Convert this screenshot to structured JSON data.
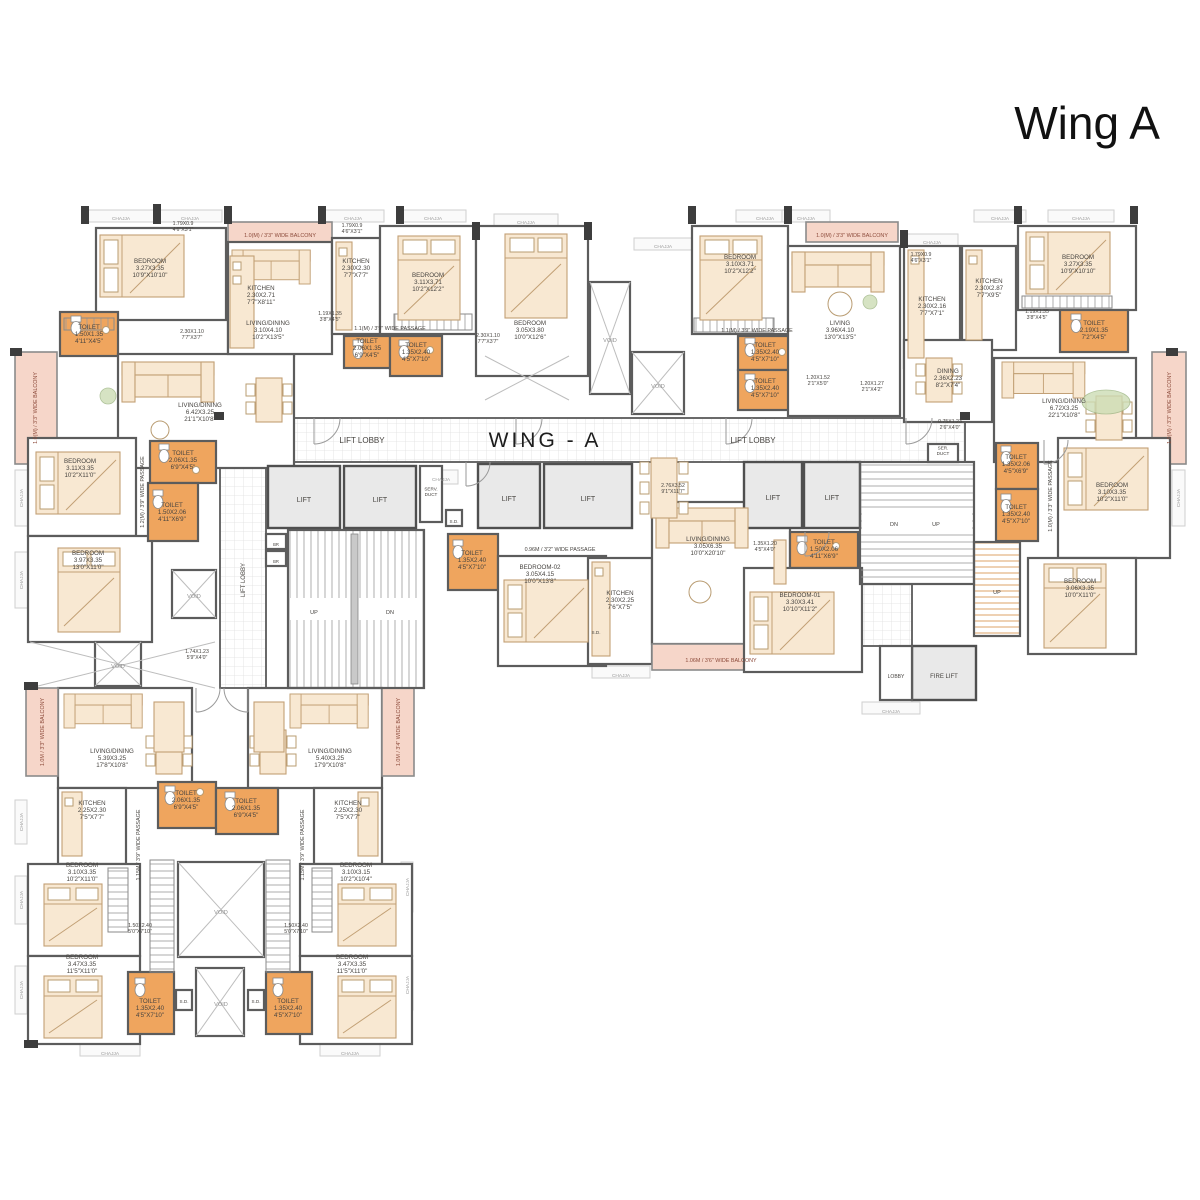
{
  "title": "Wing A",
  "colors": {
    "wall": "#5c5c5c",
    "label": "#474440",
    "heading": "#1d1d1d",
    "balcony": "#8c4a3a",
    "void": "#8f8f8f",
    "muted": "#9a9a9a",
    "toilet_fill": "#efa55e",
    "balcony_fill": "#f6d6c9",
    "furniture_fill": "#f8e8d2",
    "lift_fill": "#e9e9e9"
  },
  "plan": {
    "labels": [
      {
        "id": "wing-a-label",
        "t": "WING - A",
        "x": 545,
        "y": 445,
        "s": 21,
        "sp": 3,
        "c": "heading"
      },
      {
        "t": "LIFT LOBBY",
        "x": 362,
        "y": 441,
        "s": 8
      },
      {
        "t": "LIFT LOBBY",
        "x": 753,
        "y": 441,
        "s": 8
      },
      {
        "t": "LIFT LOBBY",
        "x": 243,
        "y": 580,
        "s": 6,
        "r": -90
      },
      {
        "t": "LIFT",
        "x": 304,
        "y": 500,
        "s": 7
      },
      {
        "t": "LIFT",
        "x": 380,
        "y": 500,
        "s": 7
      },
      {
        "t": "LIFT",
        "x": 509,
        "y": 499,
        "s": 7
      },
      {
        "t": "LIFT",
        "x": 588,
        "y": 499,
        "s": 7
      },
      {
        "t": "LIFT",
        "x": 773,
        "y": 498,
        "s": 7
      },
      {
        "t": "LIFT",
        "x": 832,
        "y": 498,
        "s": 7
      },
      {
        "t": "FIRE LIFT",
        "x": 944,
        "y": 676,
        "s": 6
      },
      {
        "t": "LOBBY",
        "x": 896,
        "y": 676,
        "s": 5
      },
      {
        "t": [
          "SERV.",
          "DUCT"
        ],
        "x": 431,
        "y": 491,
        "s": 4.6
      },
      {
        "t": [
          "SER.",
          "DUCT"
        ],
        "x": 943,
        "y": 450,
        "s": 4.6
      },
      {
        "t": "UP",
        "x": 314,
        "y": 612,
        "s": 5.5
      },
      {
        "t": "DN",
        "x": 390,
        "y": 612,
        "s": 5.5
      },
      {
        "t": "DN",
        "x": 894,
        "y": 524,
        "s": 5.5
      },
      {
        "t": "UP",
        "x": 936,
        "y": 524,
        "s": 5.5
      },
      {
        "t": "UP",
        "x": 997,
        "y": 592,
        "s": 5.5
      },
      {
        "t": "BR",
        "x": 276,
        "y": 544,
        "s": 4.2
      },
      {
        "t": "BR",
        "x": 276,
        "y": 561,
        "s": 4.2
      },
      {
        "t": "S.D.",
        "x": 454,
        "y": 521,
        "s": 4.6
      },
      {
        "t": "S.D.",
        "x": 596,
        "y": 632,
        "s": 4.6
      },
      {
        "t": "S.D.",
        "x": 184,
        "y": 1001,
        "s": 4.6
      },
      {
        "t": "S.D.",
        "x": 256,
        "y": 1001,
        "s": 4.6
      },
      {
        "t": [
          "BEDROOM",
          "3.27X3.35",
          "10'9\"X10'10\""
        ],
        "x": 150,
        "y": 268
      },
      {
        "t": [
          "KITCHEN",
          "2.30X2.71",
          "7'7\"X8'11\""
        ],
        "x": 261,
        "y": 295
      },
      {
        "t": [
          "TOILET",
          "1.50X1.35",
          "4'11\"X4'5\""
        ],
        "x": 89,
        "y": 334
      },
      {
        "t": [
          "LIVING/DINING",
          "6.42X3.25",
          "21'1\"X10'8\""
        ],
        "x": 200,
        "y": 412
      },
      {
        "t": [
          "LIVING/DINING",
          "3.10X4.10",
          "10'2\"X13'5\""
        ],
        "x": 268,
        "y": 330
      },
      {
        "t": [
          "KITCHEN",
          "2.30X2.30",
          "7'7\"X7'7\""
        ],
        "x": 356,
        "y": 268
      },
      {
        "t": [
          "BEDROOM",
          "3.11X3.71",
          "10'2\"X12'2\""
        ],
        "x": 428,
        "y": 282
      },
      {
        "t": [
          "TOILET",
          "2.06X1.35",
          "6'9\"X4'5\""
        ],
        "x": 367,
        "y": 348
      },
      {
        "t": [
          "TOILET",
          "1.35X2.40",
          "4'5\"X7'10\""
        ],
        "x": 416,
        "y": 352
      },
      {
        "t": [
          "BEDROOM",
          "3.05X3.80",
          "10'0\"X12'6\""
        ],
        "x": 530,
        "y": 330
      },
      {
        "t": [
          "BEDROOM",
          "3.10X3.71",
          "10'2\"X12'2\""
        ],
        "x": 740,
        "y": 264
      },
      {
        "t": [
          "LIVING",
          "3.96X4.10",
          "13'0\"X13'5\""
        ],
        "x": 840,
        "y": 330
      },
      {
        "t": [
          "TOILET",
          "1.35X2.40",
          "4'5\"X7'10\""
        ],
        "x": 765,
        "y": 352
      },
      {
        "t": [
          "TOILET",
          "1.35X2.40",
          "4'5\"X7'10\""
        ],
        "x": 765,
        "y": 388
      },
      {
        "t": [
          "KITCHEN",
          "2.30X2.16",
          "7'7\"X7'1\""
        ],
        "x": 932,
        "y": 306
      },
      {
        "t": [
          "KITCHEN",
          "2.30X2.87",
          "7'7\"X9'5\""
        ],
        "x": 989,
        "y": 288
      },
      {
        "t": [
          "BEDROOM",
          "3.27X3.35",
          "10'9\"X10'10\""
        ],
        "x": 1078,
        "y": 264
      },
      {
        "t": [
          "TOILET",
          "2.19X1.35",
          "7'2\"X4'5\""
        ],
        "x": 1094,
        "y": 330
      },
      {
        "t": [
          "DINING",
          "2.36X2.23",
          "8'2\"X7'4\""
        ],
        "x": 948,
        "y": 378
      },
      {
        "t": [
          "LIVING/DINING",
          "6.72X3.25",
          "22'1\"X10'8\""
        ],
        "x": 1064,
        "y": 408
      },
      {
        "t": [
          "BEDROOM",
          "3.11X3.35",
          "10'2\"X11'0\""
        ],
        "x": 80,
        "y": 468
      },
      {
        "t": [
          "BEDROOM",
          "3.97X3.35",
          "13'0\"X11'0\""
        ],
        "x": 88,
        "y": 560
      },
      {
        "t": [
          "TOILET",
          "2.06X1.35",
          "6'9\"X4'5\""
        ],
        "x": 183,
        "y": 460
      },
      {
        "t": [
          "TOILET",
          "1.50X2.06",
          "4'11\"X6'9\""
        ],
        "x": 172,
        "y": 512
      },
      {
        "t": [
          "BEDROOM-02",
          "3.05X4.15",
          "10'0\"X13'8\""
        ],
        "x": 540,
        "y": 574
      },
      {
        "t": [
          "KITCHEN",
          "2.30X2.25",
          "7'6\"X7'5\""
        ],
        "x": 620,
        "y": 600
      },
      {
        "t": [
          "LIVING/DINING",
          "3.05X6.35",
          "10'0\"X20'10\""
        ],
        "x": 708,
        "y": 546
      },
      {
        "t": [
          "TOILET",
          "1.35X2.40",
          "4'5\"X7'10\""
        ],
        "x": 472,
        "y": 560
      },
      {
        "t": [
          "BEDROOM-01",
          "3.30X3.41",
          "10'10\"X11'2\""
        ],
        "x": 800,
        "y": 602
      },
      {
        "t": [
          "TOILET",
          "1.50X2.06",
          "4'11\"X6'9\""
        ],
        "x": 824,
        "y": 549
      },
      {
        "t": [
          "TOILET",
          "1.35X2.06",
          "4'5\"X6'9\""
        ],
        "x": 1016,
        "y": 464
      },
      {
        "t": [
          "TOILET",
          "1.35X2.40",
          "4'5\"X7'10\""
        ],
        "x": 1016,
        "y": 514
      },
      {
        "t": [
          "BEDROOM",
          "3.10X3.35",
          "10'2\"X11'0\""
        ],
        "x": 1112,
        "y": 492
      },
      {
        "t": [
          "BEDROOM",
          "3.06X3.35",
          "10'0\"X11'0\""
        ],
        "x": 1080,
        "y": 588
      },
      {
        "t": [
          "LIVING/DINING",
          "5.39X3.25",
          "17'8\"X10'8\""
        ],
        "x": 112,
        "y": 758
      },
      {
        "t": [
          "LIVING/DINING",
          "5.40X3.25",
          "17'9\"X10'8\""
        ],
        "x": 330,
        "y": 758
      },
      {
        "t": [
          "KITCHEN",
          "2.25X2.30",
          "7'5\"X7'7\""
        ],
        "x": 92,
        "y": 810
      },
      {
        "t": [
          "KITCHEN",
          "2.25X2.30",
          "7'5\"X7'7\""
        ],
        "x": 348,
        "y": 810
      },
      {
        "t": [
          "TOILET",
          "2.06X1.35",
          "6'9\"X4'5\""
        ],
        "x": 186,
        "y": 800
      },
      {
        "t": [
          "TOILET",
          "2.06X1.35",
          "6'9\"X4'5\""
        ],
        "x": 246,
        "y": 808
      },
      {
        "t": [
          "BEDROOM",
          "3.10X3.35",
          "10'2\"X11'0\""
        ],
        "x": 82,
        "y": 872
      },
      {
        "t": [
          "BEDROOM",
          "3.10X3.15",
          "10'2\"X10'4\""
        ],
        "x": 356,
        "y": 872
      },
      {
        "t": [
          "BEDROOM",
          "3.47X3.35",
          "11'5\"X11'0\""
        ],
        "x": 82,
        "y": 964
      },
      {
        "t": [
          "BEDROOM",
          "3.47X3.35",
          "11'5\"X11'0\""
        ],
        "x": 352,
        "y": 964
      },
      {
        "t": [
          "TOILET",
          "1.35X2.40",
          "4'5\"X7'10\""
        ],
        "x": 150,
        "y": 1008
      },
      {
        "t": [
          "TOILET",
          "1.35X2.40",
          "4'5\"X7'10\""
        ],
        "x": 288,
        "y": 1008
      },
      {
        "t": [
          "1.79X0.9",
          "4'6\"X3'1\""
        ],
        "x": 183,
        "y": 226,
        "s": 5.2
      },
      {
        "t": [
          "1.79X0.9",
          "4'6\"X3'1\""
        ],
        "x": 352,
        "y": 228,
        "s": 5.2
      },
      {
        "t": [
          "1.79X0.9",
          "4'6\"X3'1\""
        ],
        "x": 921,
        "y": 257,
        "s": 5.2
      },
      {
        "t": [
          "1.19X1.35",
          "3'8\"X4'5\""
        ],
        "x": 330,
        "y": 316,
        "s": 5.2
      },
      {
        "t": [
          "1.19X1.35",
          "3'8\"X4'5\""
        ],
        "x": 1037,
        "y": 314,
        "s": 5.2
      },
      {
        "t": [
          "2.30X1.10",
          "7'7\"X3'7\""
        ],
        "x": 192,
        "y": 334,
        "s": 5.2
      },
      {
        "t": [
          "2.30X1.10",
          "7'7\"X3'7\""
        ],
        "x": 488,
        "y": 338,
        "s": 5.2
      },
      {
        "t": [
          "1.20X1.52",
          "2'1\"X5'0\""
        ],
        "x": 818,
        "y": 380,
        "s": 5.2
      },
      {
        "t": [
          "1.20X1.27",
          "2'1\"X4'2\""
        ],
        "x": 872,
        "y": 386,
        "s": 5.2
      },
      {
        "t": [
          "0.75X1.23",
          "2'6\"X4'0\""
        ],
        "x": 950,
        "y": 424,
        "s": 5.2
      },
      {
        "t": [
          "1.35X1.20",
          "4'5\"X4'0\""
        ],
        "x": 765,
        "y": 546,
        "s": 5.2
      },
      {
        "t": [
          "2.76X3.52",
          "9'1\"X11'7\""
        ],
        "x": 673,
        "y": 488,
        "s": 5.2
      },
      {
        "t": [
          "1.74X1.23",
          "5'9\"X4'0\""
        ],
        "x": 197,
        "y": 654,
        "s": 5.2
      },
      {
        "t": [
          "1.50X2.40",
          "5'0\"X7'10\""
        ],
        "x": 140,
        "y": 928,
        "s": 5.2
      },
      {
        "t": [
          "1.50X2.40",
          "5'0\"X7'10\""
        ],
        "x": 296,
        "y": 928,
        "s": 5.2
      },
      {
        "t": "1.1(M) / 3'9\" WIDE PASSAGE",
        "x": 390,
        "y": 328,
        "s": 5.4
      },
      {
        "t": "1.1(M) / 3'9\" WIDE PASSAGE",
        "x": 757,
        "y": 330,
        "s": 5.4
      },
      {
        "t": "0.96M / 3'2\" WIDE PASSAGE",
        "x": 560,
        "y": 549,
        "s": 5.4
      },
      {
        "t": "1.2(M) / 3'9\" WIDE PASSAGE",
        "x": 142,
        "y": 492,
        "s": 5.4,
        "r": -90
      },
      {
        "t": "1.0(M) / 3'3\" WIDE PASSAGE",
        "x": 1050,
        "y": 496,
        "s": 5.4,
        "r": -90
      },
      {
        "t": "1.15M / 3'9\" WIDE PASSAGE",
        "x": 138,
        "y": 845,
        "s": 5.4,
        "r": -90
      },
      {
        "t": "1.15M / 3'9\" WIDE PASSAGE",
        "x": 302,
        "y": 845,
        "s": 5.4,
        "r": -90
      },
      {
        "t": "1.0(M) / 3'3\" WIDE BALCONY",
        "x": 280,
        "y": 235,
        "s": 5.4,
        "c": "balcony"
      },
      {
        "t": "1.0(M) / 3'3\" WIDE BALCONY",
        "x": 852,
        "y": 235,
        "s": 5.4,
        "c": "balcony"
      },
      {
        "t": "1.0(M) / 3'3\" WIDE BALCONY",
        "x": 35,
        "y": 408,
        "s": 5.4,
        "r": -90,
        "c": "balcony"
      },
      {
        "t": "1.0(M) / 3'3\" WIDE BALCONY",
        "x": 1169,
        "y": 408,
        "s": 5.4,
        "r": -90,
        "c": "balcony"
      },
      {
        "t": "1.06M / 3'6\" WIDE BALCONY",
        "x": 721,
        "y": 660,
        "s": 5.4,
        "c": "balcony"
      },
      {
        "t": "1.0M / 3'3\" WIDE BALCONY",
        "x": 42,
        "y": 732,
        "s": 5.4,
        "r": -90,
        "c": "balcony"
      },
      {
        "t": "1.0M / 3'4\" WIDE BALCONY",
        "x": 398,
        "y": 732,
        "s": 5.4,
        "r": -90,
        "c": "balcony"
      },
      {
        "t": "VOID",
        "x": 610,
        "y": 340,
        "s": 5.6,
        "c": "void"
      },
      {
        "t": "VOID",
        "x": 658,
        "y": 386,
        "s": 5.6,
        "c": "void"
      },
      {
        "t": "VOID",
        "x": 194,
        "y": 596,
        "s": 5.6,
        "c": "void"
      },
      {
        "t": "VOID",
        "x": 118,
        "y": 666,
        "s": 5.6,
        "c": "void"
      },
      {
        "t": "VOID",
        "x": 221,
        "y": 912,
        "s": 5.6,
        "c": "void"
      },
      {
        "t": "VOID",
        "x": 221,
        "y": 1004,
        "s": 5.6,
        "c": "void"
      },
      {
        "t": "CHAJJA",
        "x": 121,
        "y": 218,
        "s": 4.8,
        "c": "muted"
      },
      {
        "t": "CHAJJA",
        "x": 190,
        "y": 218,
        "s": 4.8,
        "c": "muted"
      },
      {
        "t": "CHAJJA",
        "x": 353,
        "y": 218,
        "s": 4.8,
        "c": "muted"
      },
      {
        "t": "CHAJJA",
        "x": 433,
        "y": 218,
        "s": 4.8,
        "c": "muted"
      },
      {
        "t": "CHAJJA",
        "x": 526,
        "y": 222,
        "s": 4.8,
        "c": "muted"
      },
      {
        "t": "CHAJJA",
        "x": 663,
        "y": 246,
        "s": 4.8,
        "c": "muted"
      },
      {
        "t": "CHAJJA",
        "x": 765,
        "y": 218,
        "s": 4.8,
        "c": "muted"
      },
      {
        "t": "CHAJJA",
        "x": 806,
        "y": 218,
        "s": 4.8,
        "c": "muted"
      },
      {
        "t": "CHAJJA",
        "x": 932,
        "y": 242,
        "s": 4.8,
        "c": "muted"
      },
      {
        "t": "CHAJJA",
        "x": 1000,
        "y": 218,
        "s": 4.8,
        "c": "muted"
      },
      {
        "t": "CHAJJA",
        "x": 1081,
        "y": 218,
        "s": 4.8,
        "c": "muted"
      },
      {
        "t": "CHAJJA",
        "x": 441,
        "y": 479,
        "s": 4.8,
        "c": "muted"
      },
      {
        "t": "CHAJJA",
        "x": 621,
        "y": 675,
        "s": 4.8,
        "c": "muted"
      },
      {
        "t": "CHAJJA",
        "x": 891,
        "y": 711,
        "s": 4.8,
        "c": "muted"
      },
      {
        "t": "CHAJJA",
        "x": 110,
        "y": 1053,
        "s": 4.8,
        "c": "muted"
      },
      {
        "t": "CHAJJA",
        "x": 350,
        "y": 1053,
        "s": 4.8,
        "c": "muted"
      },
      {
        "t": "CHAJJA",
        "x": 21,
        "y": 498,
        "s": 4.8,
        "r": -90,
        "c": "muted"
      },
      {
        "t": "CHAJJA",
        "x": 21,
        "y": 580,
        "s": 4.8,
        "r": -90,
        "c": "muted"
      },
      {
        "t": "CHAJJA",
        "x": 1178,
        "y": 498,
        "s": 4.8,
        "r": -90,
        "c": "muted"
      },
      {
        "t": "CHAJJA",
        "x": 21,
        "y": 822,
        "s": 4.8,
        "r": -90,
        "c": "muted"
      },
      {
        "t": "CHAJJA",
        "x": 21,
        "y": 900,
        "s": 4.8,
        "r": -90,
        "c": "muted"
      },
      {
        "t": "CHAJJA",
        "x": 21,
        "y": 990,
        "s": 4.8,
        "r": -90,
        "c": "muted"
      },
      {
        "t": "CHAJJA",
        "x": 407,
        "y": 887,
        "s": 4.8,
        "r": -90,
        "c": "muted"
      },
      {
        "t": "CHAJJA",
        "x": 407,
        "y": 985,
        "s": 4.8,
        "r": -90,
        "c": "muted"
      }
    ]
  }
}
